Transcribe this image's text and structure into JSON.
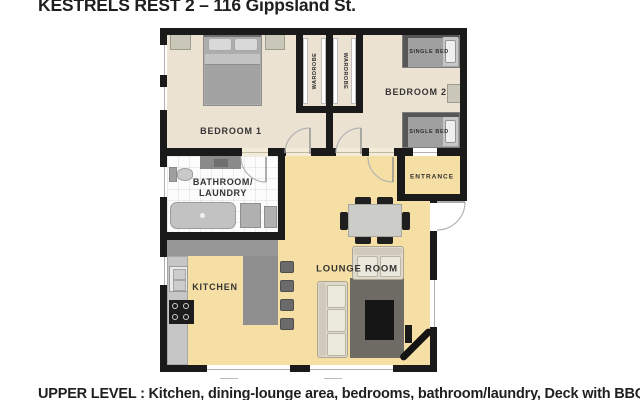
{
  "title": "KESTRELS REST 2 – 116 Gippsland St.",
  "footer": "UPPER LEVEL : Kitchen, dining-lounge area, bedrooms, bathroom/laundry, Deck with BBQ",
  "rooms": {
    "bedroom1": "BEDROOM 1",
    "bedroom2": "BEDROOM 2",
    "wardrobe_left": "WARDROBE",
    "wardrobe_right": "WARDROBE",
    "bathroom_line1": "BATHROOM/",
    "bathroom_line2": "LAUNDRY",
    "kitchen": "KITCHEN",
    "lounge": "LOUNGE ROOM",
    "entrance": "ENTRANCE"
  },
  "furniture": {
    "single_bed_top": "SINGLE BED",
    "single_bed_bottom": "SINGLE BED"
  },
  "colors": {
    "wall": "#1a1a1a",
    "bedroom_floor": "#ebe2d2",
    "living_floor": "#f6dfa4",
    "bathroom_floor": "#fcfcfc",
    "counter": "#989898",
    "rug": "#6e6a64",
    "sofa": "#ded9cb",
    "door_arc": "#b4b4b4"
  }
}
